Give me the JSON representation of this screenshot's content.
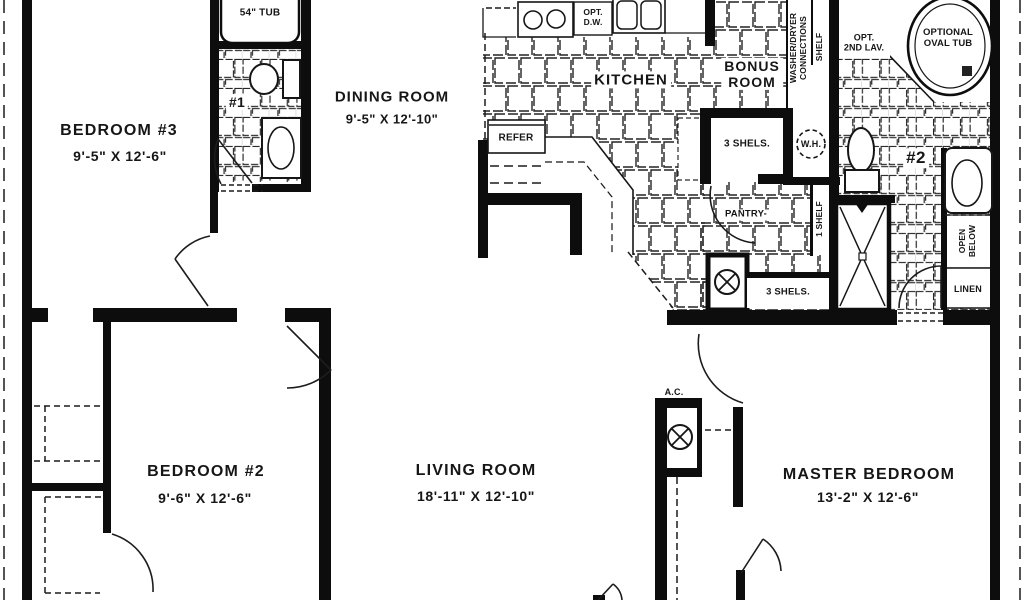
{
  "rooms": {
    "bedroom3": {
      "name": "BEDROOM #3",
      "dims": "9'-5\" X 12'-6\""
    },
    "dining": {
      "name": "DINING ROOM",
      "dims": "9'-5\" X 12'-10\""
    },
    "kitchen": {
      "name": "KITCHEN"
    },
    "bonus": {
      "line1": "BONUS",
      "line2": "ROOM"
    },
    "bedroom2": {
      "name": "BEDROOM #2",
      "dims": "9'-6\" X 12'-6\""
    },
    "living": {
      "name": "LIVING ROOM",
      "dims": "18'-11\" X 12'-10\""
    },
    "master": {
      "name": "MASTER BEDROOM",
      "dims": "13'-2\" X 12'-6\""
    }
  },
  "labels": {
    "tub54": "54\" TUB",
    "bath1_number": "#1",
    "bath2_number": "#2",
    "refer": "REFER",
    "opt_dw": {
      "line1": "OPT.",
      "line2": "D.W."
    },
    "washer_dryer": {
      "line1": "WASHER/DRYER",
      "line2": "CONNECTIONS"
    },
    "shelf": "SHELF",
    "opt_2nd_lav": {
      "line1": "OPT.",
      "line2": "2ND LAV."
    },
    "optional_oval_tub": {
      "line1": "OPTIONAL",
      "line2": "OVAL TUB"
    },
    "shelves_upper": "3 SHELS.",
    "water_heater": "W.H.",
    "pantry": "PANTRY-",
    "one_shelf": "1 SHELF",
    "shelves_lower": "3 SHELS.",
    "open_below": {
      "line1": "OPEN",
      "line2": "BELOW"
    },
    "linen": "LINEN",
    "ac": "A.C."
  },
  "colors": {
    "ink": "#161616",
    "wall": "#0d0d0d",
    "paper": "#ffffff"
  }
}
